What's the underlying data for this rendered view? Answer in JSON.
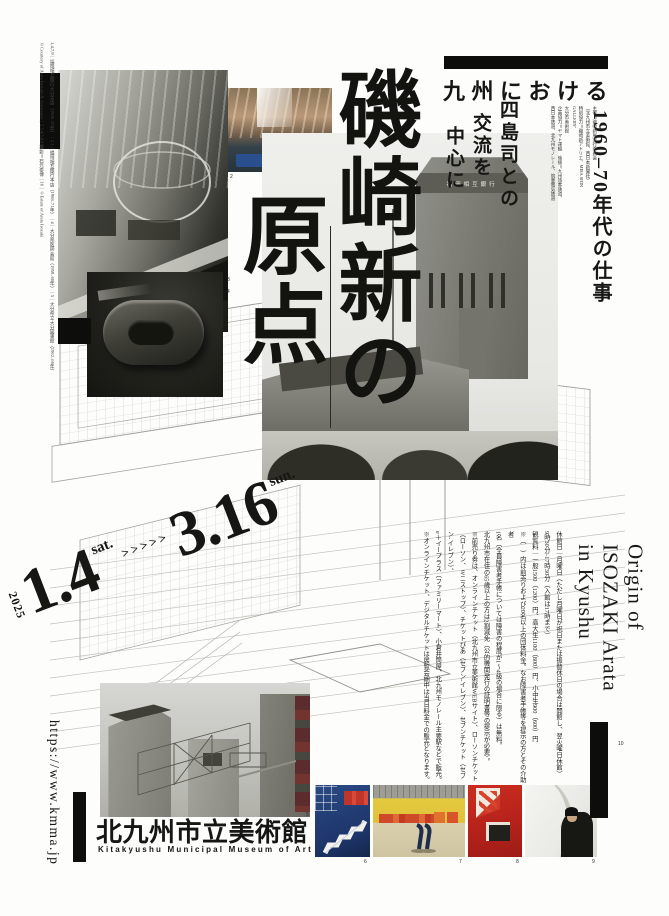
{
  "header": {
    "region_line": "九州における",
    "era_line": "1960–70年代の仕事",
    "focus": {
      "c1": "四島司との",
      "c2": "交流を",
      "c3": "中心に"
    },
    "credits": [
      "主催＝磯崎新展実行委員会",
      "（北九州市立美術館、西日本新聞社）",
      "特別協力＝磯崎新アトリエ、MISA SHIN GALLERY、",
      "大分市美術館",
      "企画協力＝ヤマト運輸　後援＝九州旅客鉄道、",
      "西日本鉄道、北九州モノレール、筑豊電気鉄道"
    ]
  },
  "title": {
    "column_right": "磯崎新の",
    "column_left": "原点"
  },
  "dates": {
    "year": "2025",
    "start_date": "1.4",
    "start_day": "sat.",
    "arrows": ">>>>>",
    "end_date": "3.16",
    "end_day": "sun."
  },
  "english_title": {
    "line1": "Origin of",
    "line2": "ISOZAKI Arata",
    "line3": "in Kyushu"
  },
  "info": {
    "lines": [
      "休館日｜月曜日（ただし月曜日が祝日または振替休日の場合は開館し、翌火曜日休館）",
      "9時30分–17時30分（入館は17時まで）",
      "観覧料｜一般1500（1200）円、高大生1100（800）円、小中生900（600）円",
      "※（　）内は前売りおよび20名以上の団体料金。なお障害者手帳等を提示の方とその介助者",
      "1名（全員障害者手帳については障害の程度が1～4級の場合に限る）は無料。",
      "北九州市在住の65歳以上の方は2割減免（公的機関発行の証明書等の提示が必要）。",
      "※前売り券は、オンラインチケット（北九州市立美術館WEBサイト）、ローソンチケット",
      "（ローソン、ミニストップ）、チケットぴあ（セブン-イレブン）、セブンチケット（セブン-イレブン）、",
      "e＋イープラス（ファミリーマート）、小倉井筒屋、北九州モノレール主要駅などで販売。",
      "※オンラインチケット、デジタルチケットは展覧会期中は当日料金での販売となります。"
    ]
  },
  "venue": {
    "name_ja": "北九州市立美術館",
    "name_en": "Kitakyushu Municipal Museum of Art",
    "url": "https://www.kmma.jp"
  },
  "photos": {
    "tower_sign": "福岡相互銀行"
  },
  "labels": [
    "2",
    "3",
    "4",
    "5",
    "6",
    "7",
    "8",
    "9",
    "10"
  ],
  "side_captions": {
    "col_a": "1,4,7,9｜福岡相互銀行大分支店（1966–67年）｜2,3｜福岡相互銀行本店（1968–71年）｜4｜大分県医師会館（1959–60年）｜5｜大分県立大分図書館（1962–66年）",
    "col_b": "©Courtesy of Arata Isozaki & Associates｜2,3,4,5,8,9 撮影＝石元泰博｜10｜©Estate of Arata Isozaki"
  }
}
